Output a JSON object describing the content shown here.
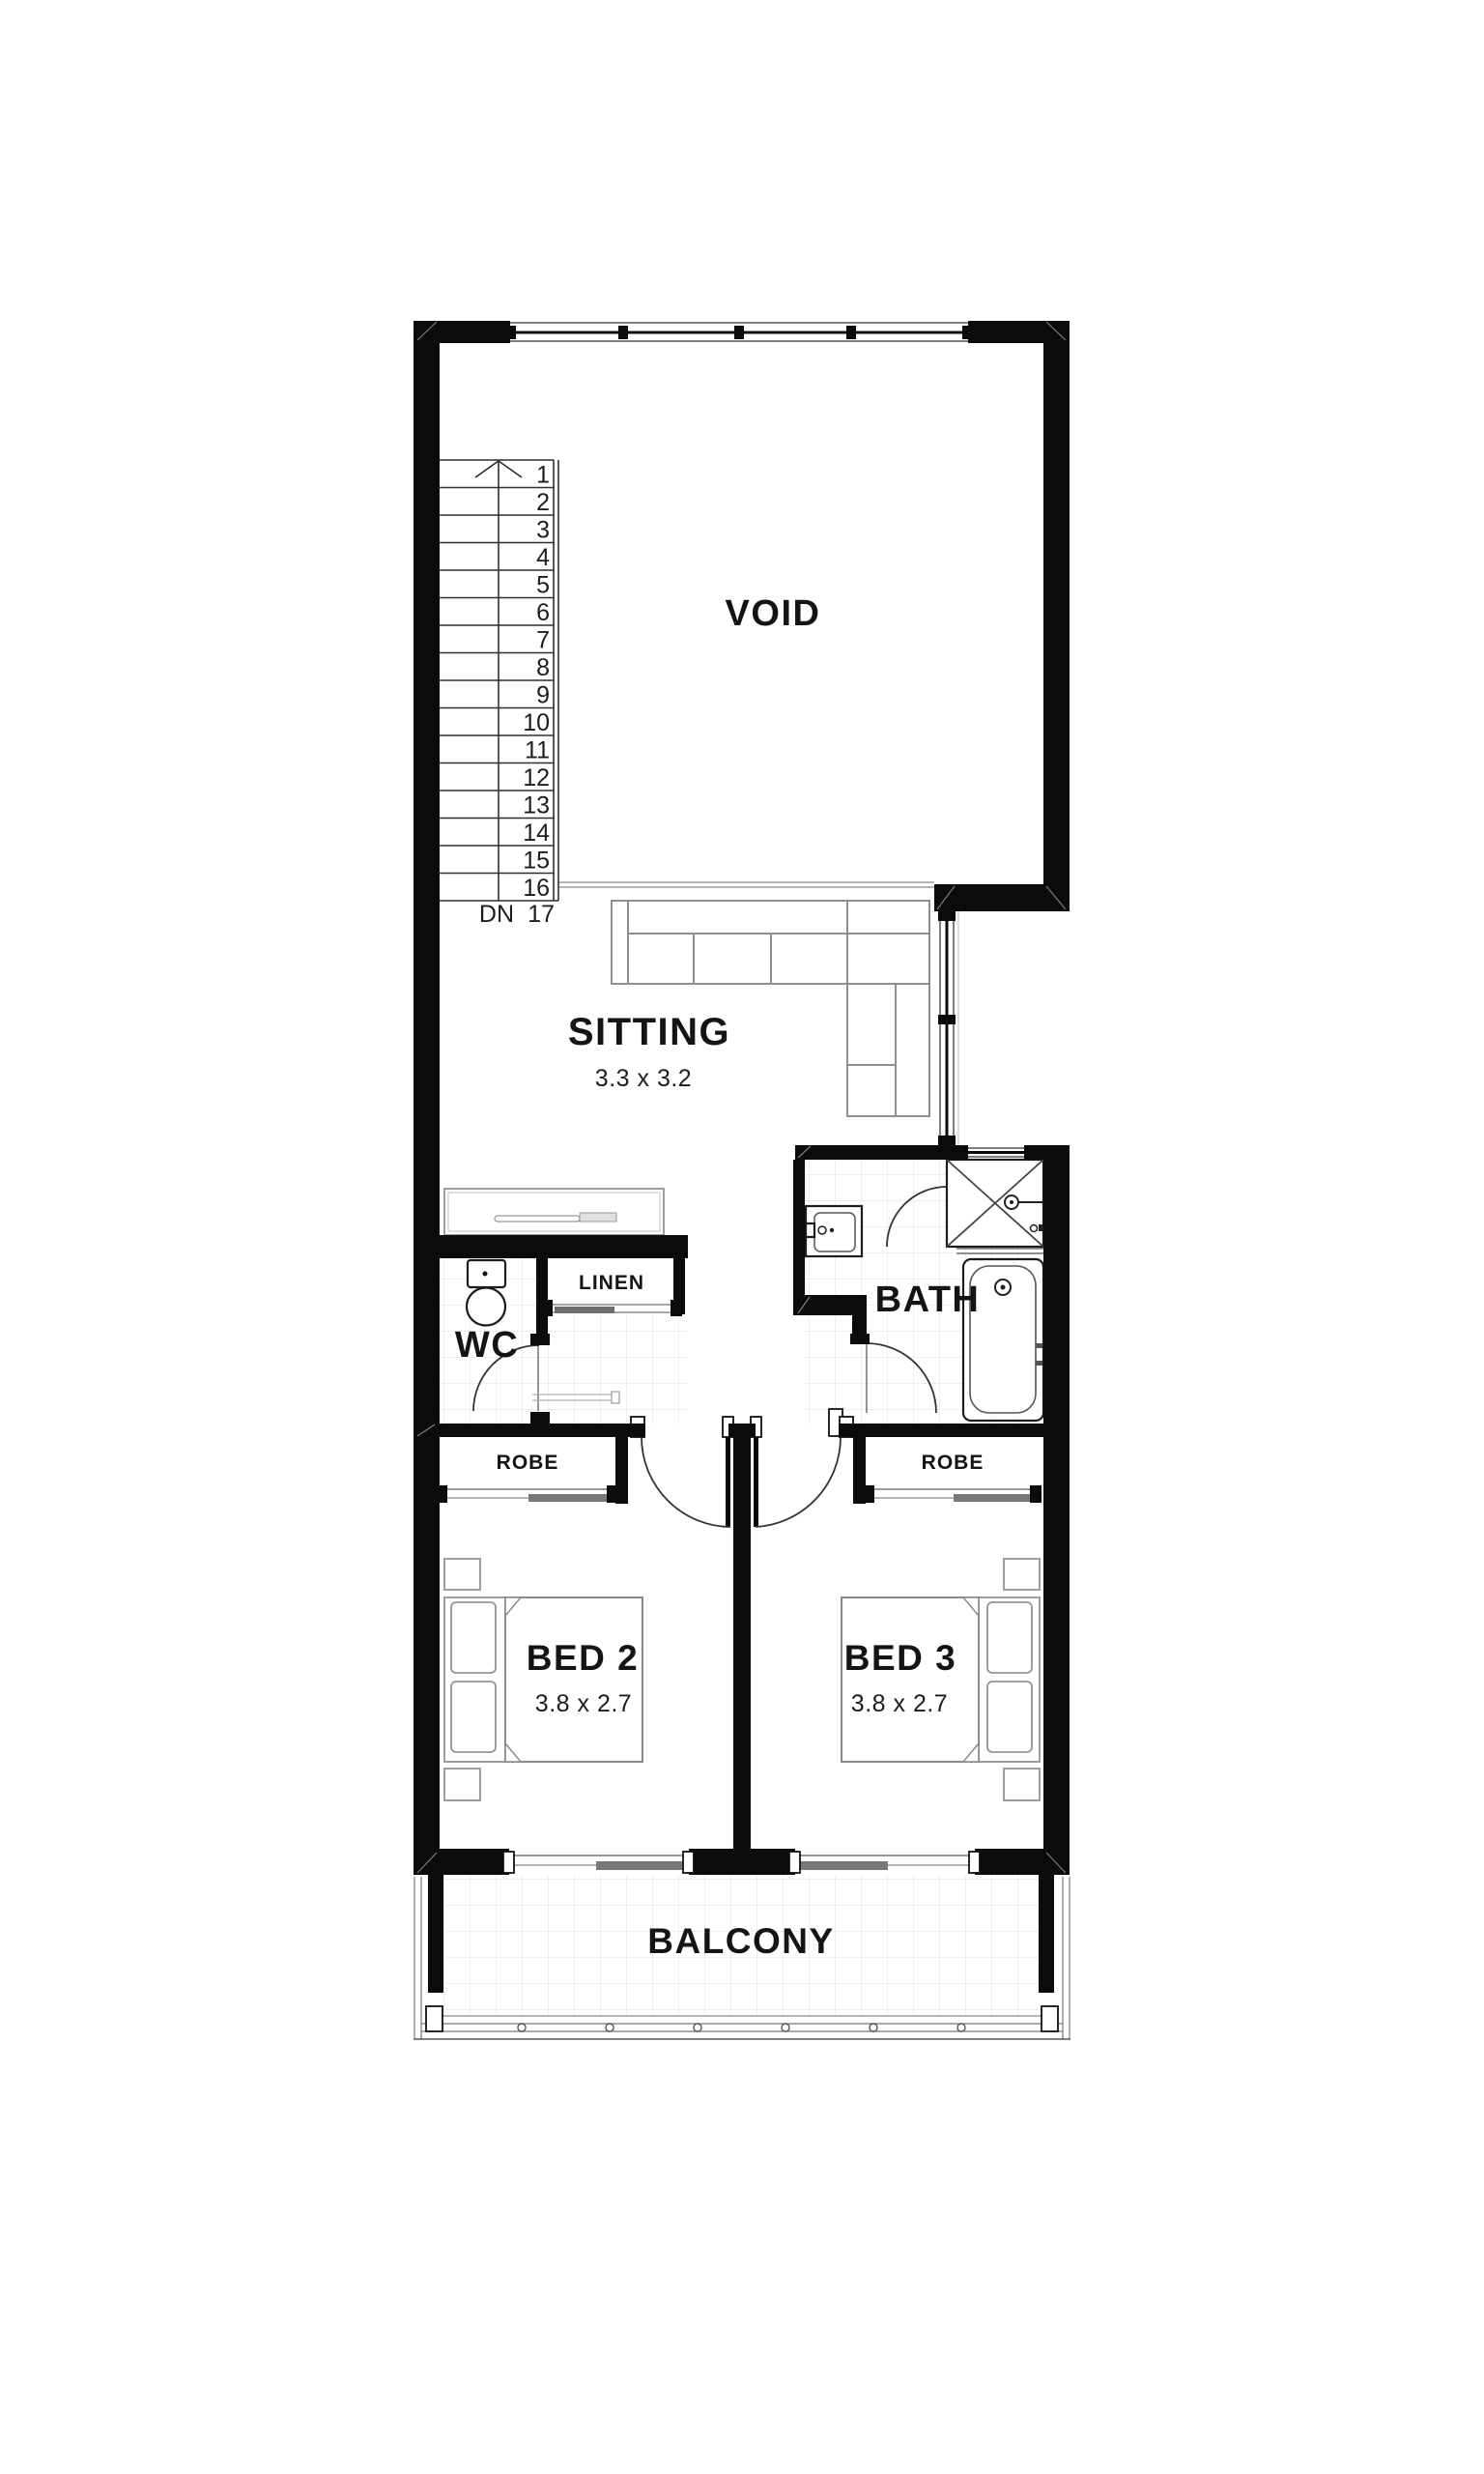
{
  "page": {
    "background": "#ffffff",
    "type": "architectural-floor-plan"
  },
  "colors": {
    "wall": "#0b0b0b",
    "line_dark": "#2f2f2f",
    "line_mid": "#8f8f8f",
    "line_light": "#c9c9c9",
    "tile_grid": "#e4e4e4",
    "text": "#141414"
  },
  "rooms": {
    "void": {
      "label": "VOID"
    },
    "sitting": {
      "label": "SITTING",
      "dims": "3.3 x 3.2"
    },
    "wc": {
      "label": "WC"
    },
    "linen": {
      "label": "LINEN"
    },
    "bath": {
      "label": "BATH"
    },
    "robe_bed2": {
      "label": "ROBE"
    },
    "robe_bed3": {
      "label": "ROBE"
    },
    "bed2": {
      "label": "BED 2",
      "dims": "3.8 x 2.7"
    },
    "bed3": {
      "label": "BED 3",
      "dims": "3.8 x 2.7"
    },
    "balcony": {
      "label": "BALCONY"
    }
  },
  "stair": {
    "dn_label": "DN",
    "landing_step": "17",
    "steps": [
      "1",
      "2",
      "3",
      "4",
      "5",
      "6",
      "7",
      "8",
      "9",
      "10",
      "11",
      "12",
      "13",
      "14",
      "15",
      "16"
    ]
  }
}
